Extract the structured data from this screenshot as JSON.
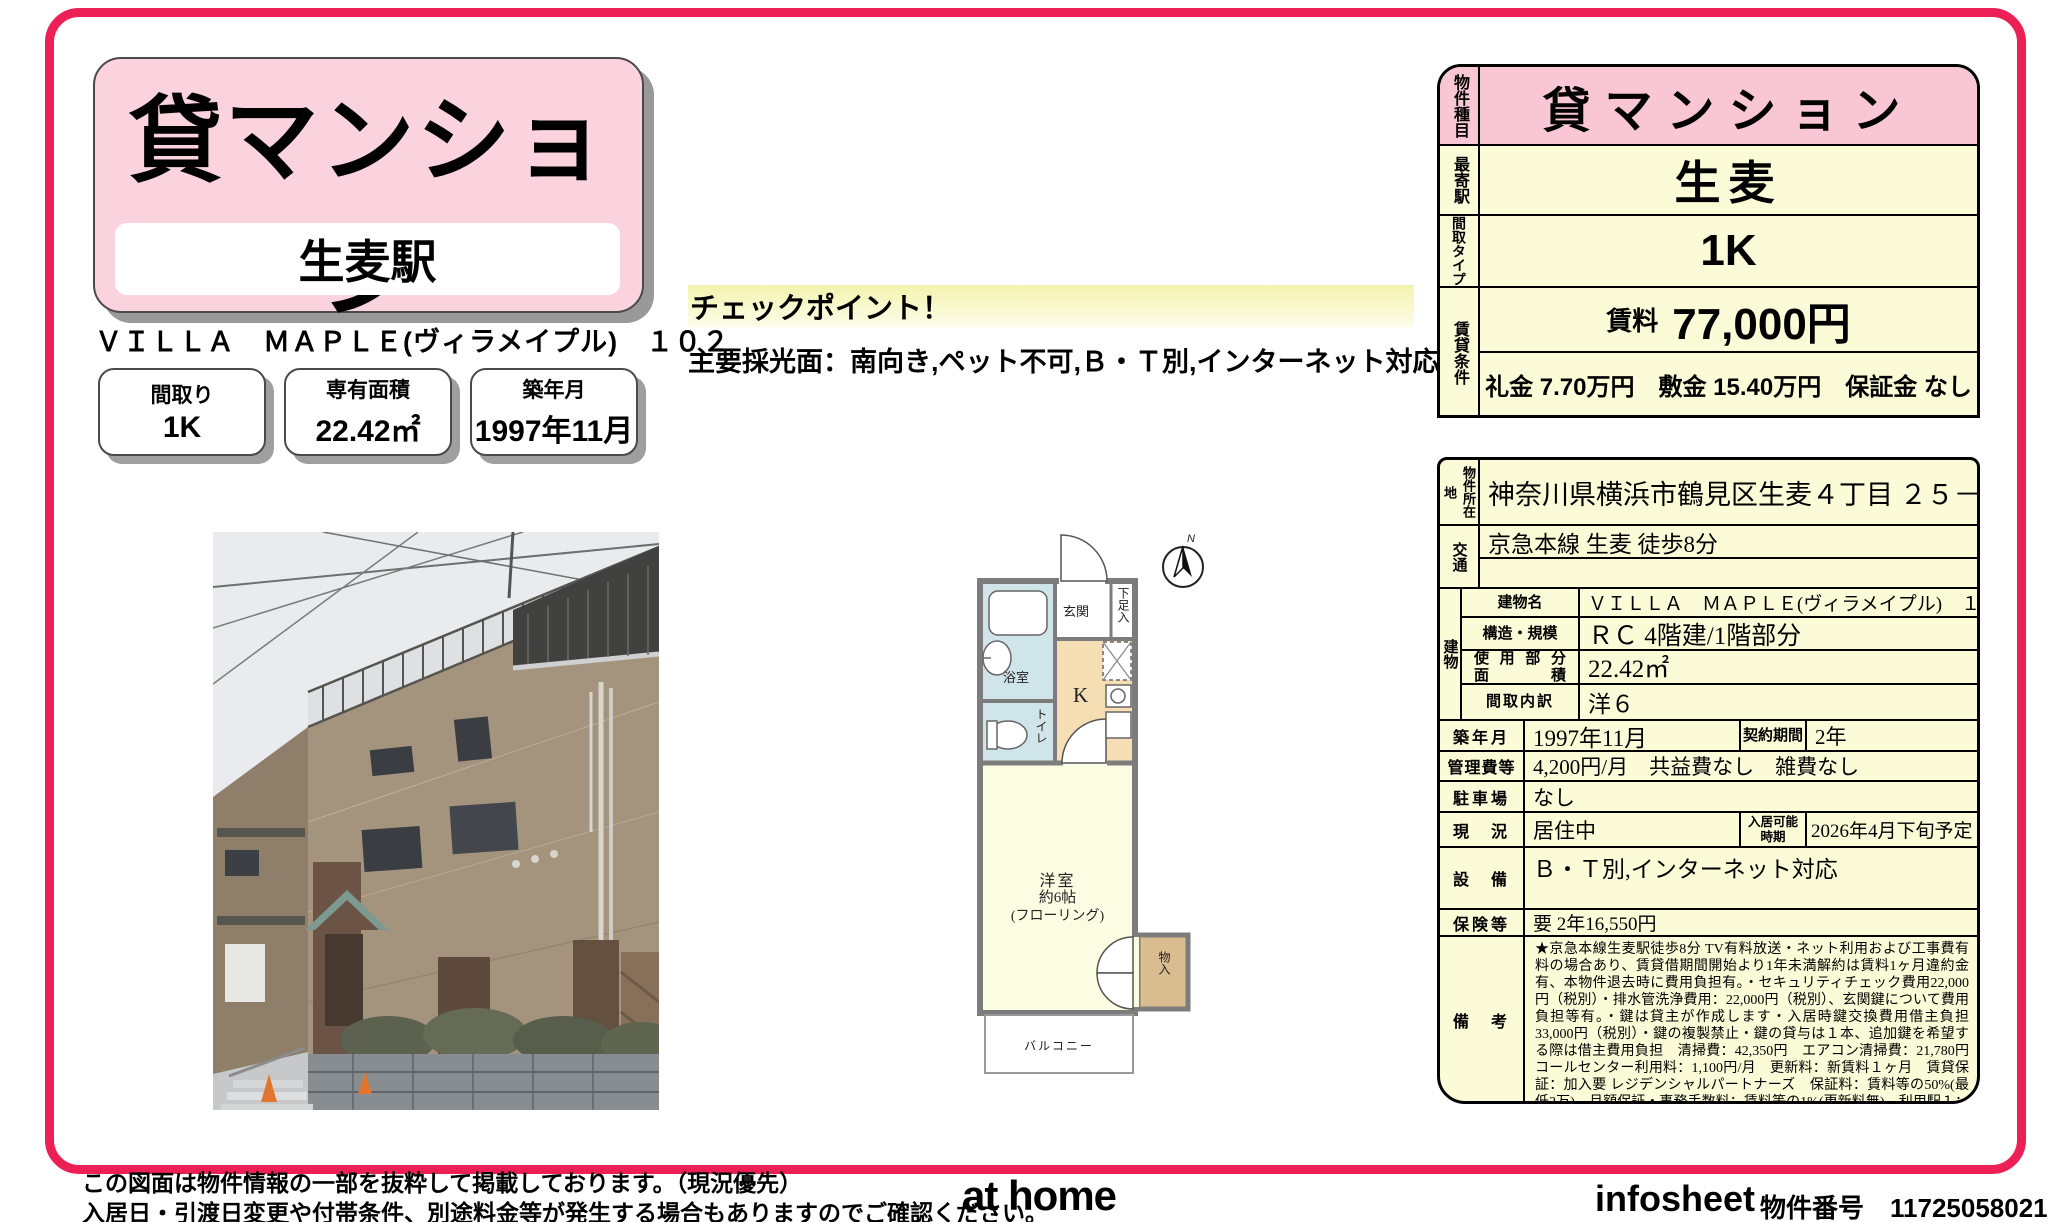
{
  "page": {
    "accent_color": "#ed2056",
    "panel_pink": "#f9c6d3",
    "panel_yellow": "#fbfbd8",
    "title": "貸マンション",
    "station_box": "生麦駅",
    "building_title": "ＶＩＬＬＡ　ＭＡＰＬＥ(ヴィラメイプル)　１０２",
    "spec_boxes": [
      {
        "label": "間取り",
        "value": "1K"
      },
      {
        "label": "専有面積",
        "value": "22.42㎡"
      },
      {
        "label": "築年月",
        "value": "1997年11月"
      }
    ]
  },
  "checkpoint": {
    "title": "チェックポイント！",
    "text": "主要採光面：南向き,ペット不可,Ｂ・Ｔ別,インターネット対応"
  },
  "floorplan": {
    "compass": "N",
    "genkan": "玄関",
    "shoe_box": "下足入",
    "bath": "浴室",
    "toilet": "トイレ",
    "kitchen": "K",
    "room_name": "洋室",
    "room_size": "約6帖",
    "room_floor": "(フローリング)",
    "closet": "物入",
    "balcony": "バルコニー"
  },
  "summary": {
    "type_label": "物件種目",
    "type_value": "貸マンション",
    "station_label": "最寄駅",
    "station_value": "生麦",
    "layout_label": "間取タイプ",
    "layout_value": "1K",
    "terms_label": "賃貸条件",
    "rent_label": "賃料",
    "rent_value": "77,000円",
    "fees": "礼金 7.70万円　敷金 15.40万円　保証金 なし"
  },
  "details": {
    "location_label": "物件所在地",
    "location_value": "神奈川県横浜市鶴見区生麦４丁目 ２５－１７",
    "access_label": "交通",
    "access_value": "京急本線 生麦 徒歩8分",
    "access_value2": "",
    "building_label": "建物",
    "building_name_label": "建物名",
    "building_name": "ＶＩＬＬＡ　ＭＡＰＬＥ(ヴィラメイプル)　１０２",
    "structure_label": "構造・規模",
    "structure": "ＲＣ 4階建/1階部分",
    "area_label_1": "使用部分",
    "area_label_2": "面積",
    "area": "22.42㎡",
    "layout_detail_label": "間取内訳",
    "layout_detail": "洋６",
    "built_label": "築年月",
    "built": "1997年11月",
    "contract_label": "契約期間",
    "contract": "2年",
    "mgmt_label": "管理費等",
    "mgmt": "4,200円/月　共益費なし　雑費なし",
    "parking_label": "駐車場",
    "parking": "なし",
    "status_label": "現　況",
    "status": "居住中",
    "movein_label_1": "入居可能",
    "movein_label_2": "時期",
    "movein": "2026年4月下旬予定",
    "equip_label": "設　備",
    "equip": "Ｂ・Ｔ別,インターネット対応",
    "insurance_label": "保険等",
    "insurance": "要 2年16,550円",
    "remarks_label": "備　考",
    "remarks": "★京急本線生麦駅徒歩8分 TV有料放送・ネット利用および工事費有料の場合あり、賃貸借期間開始より1年未満解約は賃料1ヶ月違約金有、本物件退去時に費用負担有。・セキュリティチェック費用22,000円（税別）・排水管洗浄費用：22,000円（税別）、玄関鍵について費用負担等有。・鍵は貸主が作成します・入居時鍵交換費用借主負担33,000円（税別）・鍵の複製禁止・鍵の貸与は１本、追加鍵を希望する際は借主費用負担　清掃費：42,350円　エアコン清掃費：21,780円　コールセンター利用料：1,100円/月　更新料：新賃料１ヶ月　賃貸保証：加入要 レジデンシャルパートナーズ　保証料：賃料等の50%(最低2万)、月額保証・事務手数料：賃料等の1%(更新料無)　利用駅１：ＪＲ鶴見線 国道 徒歩10分"
  },
  "footer": {
    "disclaimer1": "この図面は物件情報の一部を抜粋して掲載しております。（現況優先）",
    "disclaimer2": "入居日・引渡日変更や付帯条件、別途料金等が発生する場合もありますのでご確認ください。",
    "logo": "at home",
    "sheet_name": "infosheet",
    "property_no_label": "物件番号",
    "property_no": "11725058021"
  }
}
